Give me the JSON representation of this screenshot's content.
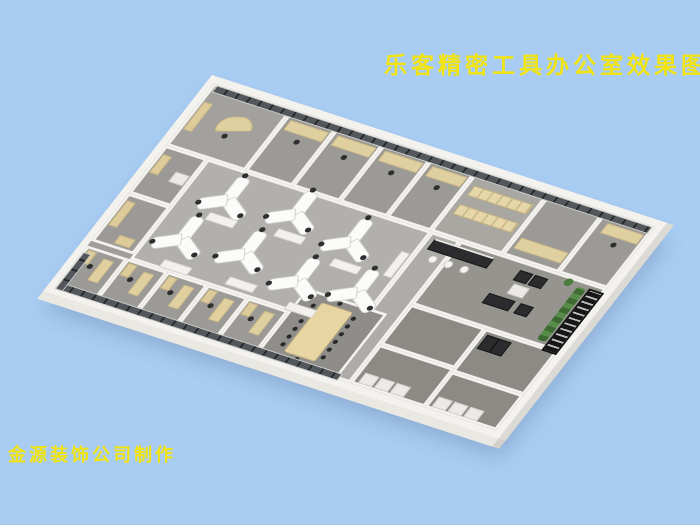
{
  "title": {
    "text": "乐客精密工具办公室效果图",
    "color": "#f2e413"
  },
  "credit": {
    "text": "金源装饰公司制作",
    "color": "#f2e413"
  },
  "scene": {
    "type": "3d-office-floorplan-render",
    "colors": {
      "background_blue": "#a8ccf2",
      "text_yellow": "#f2e413",
      "wall_white": "#f4f2ee",
      "floor_open_gray": "#b2b0ac",
      "floor_room_gray": "#9c9a96",
      "floor_dark_gray": "#8b8a85",
      "window_dark": "#24272a",
      "desk_beige": "#e0cf9f",
      "workstation_white": "#fbfbfa",
      "chair_black": "#2f2f31",
      "sofa_black": "#363638",
      "plant_green": "#578c4b",
      "stair_black": "#161616"
    }
  }
}
